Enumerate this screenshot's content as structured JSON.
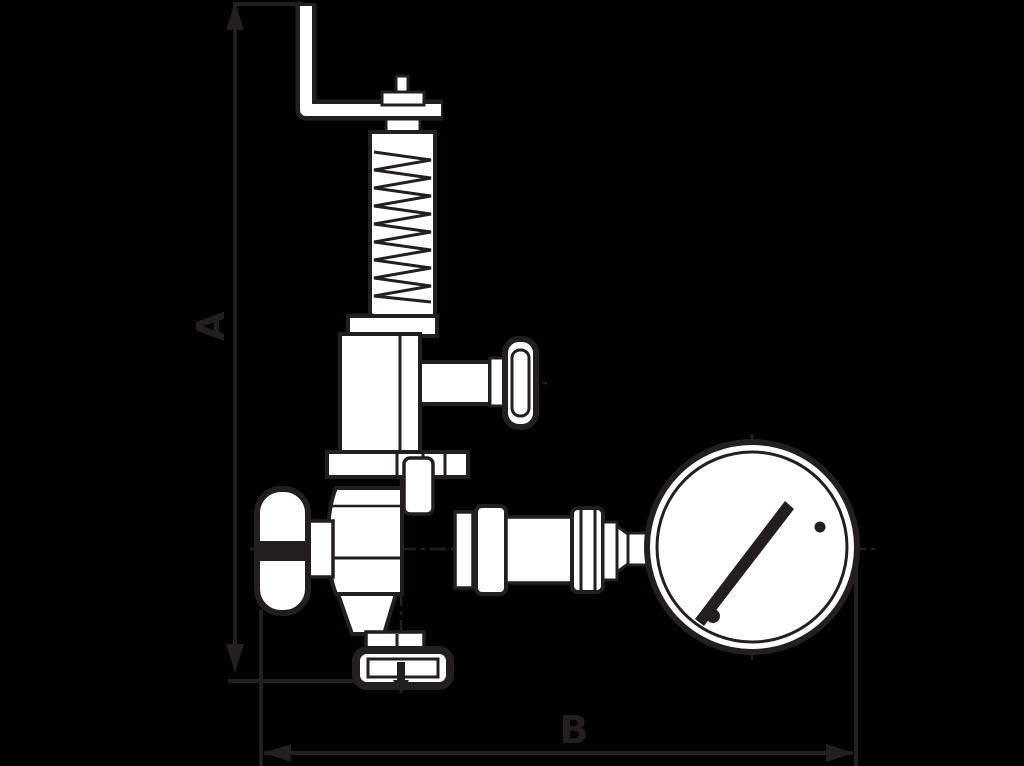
{
  "drawing": {
    "description": "Dimensional outline drawing of an angle relief valve with spring bonnet, lever, handwheel and pressure gauge",
    "colors": {
      "background": "#000000",
      "ink": "#231f20",
      "fill": "#ffffff"
    },
    "dimensions": {
      "vertical_label": "A",
      "horizontal_label": "B"
    },
    "parts": [
      "test lever",
      "adjusting spindle",
      "spring housing",
      "bonnet flange",
      "side port knob",
      "valve body",
      "handwheel",
      "outlet flange",
      "flow arrow",
      "piping unions",
      "pressure gauge"
    ]
  }
}
